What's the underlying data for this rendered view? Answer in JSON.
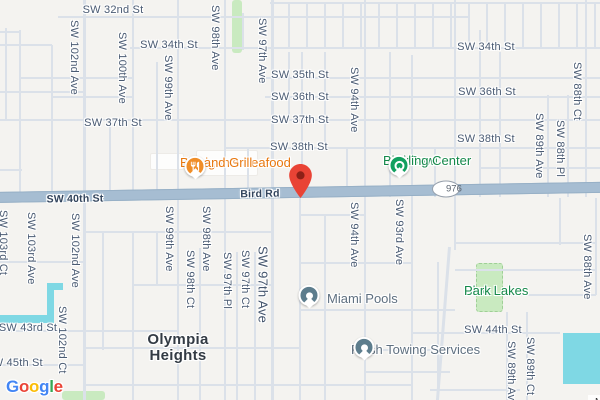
{
  "attribution": {
    "text": "Map data ©2025 Google"
  },
  "logo": {
    "letters": [
      {
        "ch": "G",
        "color": "#4285F4"
      },
      {
        "ch": "o",
        "color": "#EA4335"
      },
      {
        "ch": "o",
        "color": "#FBBC05"
      },
      {
        "ch": "g",
        "color": "#4285F4"
      },
      {
        "ch": "l",
        "color": "#34A853"
      },
      {
        "ch": "e",
        "color": "#EA4335"
      }
    ]
  },
  "route_shield": {
    "label": "976",
    "x": 446,
    "y": 189
  },
  "destination_pin": {
    "x": 300,
    "y": 198,
    "color": "#e94335",
    "inner_color": "#8c2017"
  },
  "neighborhood": {
    "lines": [
      "Olympia",
      "Heights"
    ],
    "x": 178,
    "y": 332
  },
  "colors": {
    "background": "#f4f3f0",
    "road_minor": "#dbe1e9",
    "road_major": "#a6bdd2",
    "water": "#7fd8e4",
    "park": "#c9eac0",
    "street_label": "#4a5b73",
    "road_label": "#32445c",
    "poi_orange": "#e8780f",
    "poi_green": "#15894a",
    "poi_gray": "#5f7080",
    "poi_slate_icon": "#5d7d8d"
  },
  "street_labels_h": [
    {
      "text": "SW 32nd St",
      "x": 113,
      "y": 10
    },
    {
      "text": "SW 34th St",
      "x": 169,
      "y": 45
    },
    {
      "text": "SW 34th St",
      "x": 486,
      "y": 47
    },
    {
      "text": "SW 35th St",
      "x": 300,
      "y": 75
    },
    {
      "text": "SW 36th St",
      "x": 300,
      "y": 97
    },
    {
      "text": "SW 36th St",
      "x": 487,
      "y": 92
    },
    {
      "text": "SW 37th St",
      "x": 113,
      "y": 123
    },
    {
      "text": "SW 37th St",
      "x": 300,
      "y": 120
    },
    {
      "text": "SW 38th St",
      "x": 299,
      "y": 147
    },
    {
      "text": "SW 38th St",
      "x": 486,
      "y": 139
    },
    {
      "text": "SW 43rd St",
      "x": 28,
      "y": 328
    },
    {
      "text": "SW 44th St",
      "x": 493,
      "y": 330
    },
    {
      "text": "SW 45th St",
      "x": 14,
      "y": 363
    },
    {
      "text": "SW 40th St",
      "x": 75,
      "y": 199,
      "on_road": true
    },
    {
      "text": "Bird Rd",
      "x": 260,
      "y": 194,
      "on_road": true
    }
  ],
  "street_labels_v": [
    {
      "text": "SW 102nd Ave",
      "x": 74,
      "y": 20
    },
    {
      "text": "SW 100th Ave",
      "x": 122,
      "y": 32
    },
    {
      "text": "SW 99th Ave",
      "x": 168,
      "y": 55
    },
    {
      "text": "SW 98th Ave",
      "x": 215,
      "y": 5
    },
    {
      "text": "SW 97th Ave",
      "x": 262,
      "y": 18
    },
    {
      "text": "SW 94th Ave",
      "x": 354,
      "y": 67
    },
    {
      "text": "SW 89th Ave",
      "x": 539,
      "y": 113
    },
    {
      "text": "SW 88th Pl",
      "x": 560,
      "y": 120
    },
    {
      "text": "SW 88th Ct",
      "x": 577,
      "y": 62
    },
    {
      "text": "SW 103rd Ct",
      "x": 3,
      "y": 210
    },
    {
      "text": "SW 103rd Ave",
      "x": 31,
      "y": 212
    },
    {
      "text": "SW 102nd Ave",
      "x": 75,
      "y": 213
    },
    {
      "text": "SW 102nd Ct",
      "x": 62,
      "y": 306
    },
    {
      "text": "SW 99th Ave",
      "x": 169,
      "y": 206
    },
    {
      "text": "SW 98th Ave",
      "x": 206,
      "y": 206
    },
    {
      "text": "SW 98th Ct",
      "x": 190,
      "y": 250
    },
    {
      "text": "SW 97th Pl",
      "x": 227,
      "y": 252
    },
    {
      "text": "SW 97th Ct",
      "x": 245,
      "y": 250
    },
    {
      "text": "SW 97th Ave",
      "x": 263,
      "y": 246,
      "big": true
    },
    {
      "text": "SW 94th Ave",
      "x": 354,
      "y": 202
    },
    {
      "text": "SW 93rd Ave",
      "x": 399,
      "y": 199
    },
    {
      "text": "SW 88th Ave",
      "x": 587,
      "y": 234
    },
    {
      "text": "SW 89th Ave",
      "x": 511,
      "y": 341
    },
    {
      "text": "SW 89th Ct",
      "x": 530,
      "y": 337
    }
  ],
  "pois": [
    {
      "name": "flanigans-seafood",
      "lines": [
        "Flanigan's Seafood",
        "Bar and Grill"
      ],
      "color": "orange",
      "anchor": "right",
      "x": 180,
      "y": 156,
      "icon": "restaurant",
      "icon_x": 195,
      "icon_y": 168
    },
    {
      "name": "bird-bowl",
      "lines": [
        "Bird Bowl",
        "Bowling Center"
      ],
      "color": "green",
      "anchor": "right",
      "x": 383,
      "y": 154,
      "icon": "bowling",
      "icon_x": 399,
      "icon_y": 167
    },
    {
      "name": "miami-pools",
      "lines": [
        "Miami Pools"
      ],
      "color": "gray",
      "anchor": "left",
      "x": 327,
      "y": 292,
      "icon": "generic",
      "icon_x": 309,
      "icon_y": 297
    },
    {
      "name": "flash-towing-services",
      "lines": [
        "Flash Towing Services"
      ],
      "color": "gray",
      "anchor": "right",
      "x": 351,
      "y": 343,
      "icon": "generic",
      "icon_x": 364,
      "icon_y": 349
    },
    {
      "name": "blue-lakes-park",
      "lines": [
        "Blue Lakes",
        "Park"
      ],
      "color": "green",
      "anchor": "center",
      "x": 464,
      "y": 284,
      "icon": null
    }
  ],
  "roads": {
    "v": [
      [
        6,
        28,
        120
      ],
      [
        20,
        30,
        197
      ],
      [
        52,
        45,
        197
      ],
      [
        84,
        0,
        400,
        3
      ],
      [
        103,
        232,
        350
      ],
      [
        110,
        120,
        197
      ],
      [
        133,
        0,
        197
      ],
      [
        133,
        232,
        400
      ],
      [
        157,
        62,
        197
      ],
      [
        157,
        232,
        285
      ],
      [
        178,
        0,
        400
      ],
      [
        200,
        248,
        400
      ],
      [
        225,
        0,
        400
      ],
      [
        243,
        13,
        50
      ],
      [
        248,
        148,
        197
      ],
      [
        237,
        252,
        400
      ],
      [
        255,
        252,
        400
      ],
      [
        272,
        0,
        400,
        3
      ],
      [
        289,
        52,
        120
      ],
      [
        302,
        52,
        197
      ],
      [
        325,
        52,
        148
      ],
      [
        325,
        215,
        400
      ],
      [
        347,
        148,
        197
      ],
      [
        300,
        198,
        400
      ],
      [
        365,
        0,
        400
      ],
      [
        390,
        52,
        197
      ],
      [
        412,
        55,
        400
      ],
      [
        435,
        148,
        197
      ],
      [
        438,
        262,
        400
      ],
      [
        455,
        0,
        250
      ],
      [
        480,
        30,
        197
      ],
      [
        500,
        52,
        197
      ],
      [
        507,
        312,
        400
      ],
      [
        527,
        312,
        400
      ],
      [
        548,
        95,
        197
      ],
      [
        568,
        95,
        197
      ],
      [
        586,
        0,
        197
      ],
      [
        596,
        198,
        295
      ],
      [
        560,
        198,
        245
      ]
    ],
    "h": [
      [
        17,
        58,
        470
      ],
      [
        3,
        270,
        600
      ],
      [
        32,
        0,
        20
      ],
      [
        45,
        0,
        52
      ],
      [
        48,
        130,
        600
      ],
      [
        78,
        20,
        133
      ],
      [
        78,
        265,
        600
      ],
      [
        92,
        0,
        84
      ],
      [
        97,
        52,
        133
      ],
      [
        97,
        265,
        600
      ],
      [
        120,
        0,
        600
      ],
      [
        148,
        225,
        600
      ],
      [
        168,
        480,
        600
      ],
      [
        170,
        0,
        22
      ],
      [
        215,
        300,
        365
      ],
      [
        232,
        84,
        272
      ],
      [
        243,
        455,
        596
      ],
      [
        262,
        0,
        84
      ],
      [
        263,
        300,
        412
      ],
      [
        270,
        455,
        596
      ],
      [
        285,
        133,
        272
      ],
      [
        295,
        505,
        596
      ],
      [
        310,
        300,
        455
      ],
      [
        331,
        0,
        178
      ],
      [
        333,
        412,
        560
      ],
      [
        348,
        84,
        300
      ],
      [
        350,
        365,
        455
      ],
      [
        365,
        0,
        84
      ],
      [
        372,
        365,
        450
      ],
      [
        385,
        84,
        412
      ],
      [
        390,
        430,
        520
      ]
    ],
    "diag": [
      [
        449,
        247,
        156,
        4.5
      ]
    ]
  },
  "water": [
    [
      47,
      283,
      16,
      7
    ],
    [
      47,
      283,
      7,
      38
    ],
    [
      0,
      315,
      54,
      8
    ],
    [
      563,
      333,
      37,
      51
    ]
  ],
  "parks": [
    [
      232,
      0,
      10,
      53,
      0
    ],
    [
      476,
      263,
      27,
      49,
      1
    ],
    [
      62,
      391,
      43,
      9,
      0
    ]
  ],
  "buildings": [
    [
      196,
      150,
      62,
      26
    ],
    [
      150,
      153,
      34,
      17
    ]
  ]
}
